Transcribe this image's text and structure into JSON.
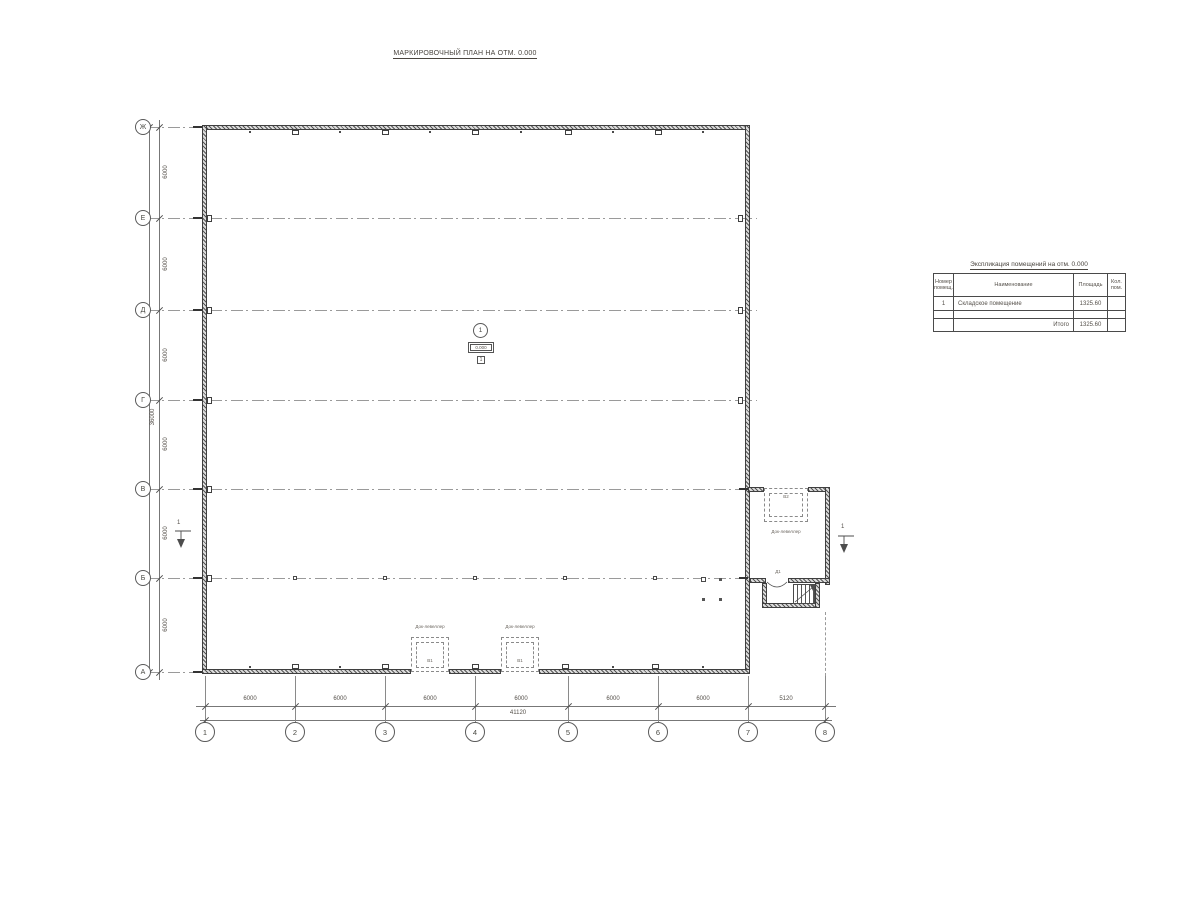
{
  "drawing_title": "МАРКИРОВОЧНЫЙ ПЛАН НА ОТМ. 0.000",
  "axis_rows": [
    "Ж",
    "Е",
    "Д",
    "Г",
    "В",
    "Б",
    "А"
  ],
  "axis_cols": [
    "1",
    "2",
    "3",
    "4",
    "5",
    "6",
    "7",
    "8"
  ],
  "dims": {
    "left_segments": [
      "6000",
      "6000",
      "6000",
      "6000",
      "6000",
      "6000"
    ],
    "left_total": "36000",
    "bottom_segments": [
      "6000",
      "6000",
      "6000",
      "6000",
      "6000",
      "6000",
      "5120"
    ],
    "bottom_total": "41120"
  },
  "room_tag": {
    "number": "1",
    "elevation": "0.000",
    "marker": "1"
  },
  "docks": {
    "label": "Док-левеллер",
    "tags": {
      "bottom_left": "В1",
      "bottom_right": "В1",
      "side": "В2"
    }
  },
  "door_tag": "Д1",
  "section_marks": {
    "left": "1",
    "right": "1"
  },
  "expl_table": {
    "title": "Экспликация помещений на отм. 0.000",
    "headers": {
      "num": "Номер помещ.",
      "name": "Наименование",
      "area": "Площадь",
      "count": "Кол. пом."
    },
    "rows": [
      {
        "num": "1",
        "name": "Складское помещение",
        "area": "1325.60",
        "count": ""
      },
      {
        "num": "",
        "name": "",
        "area": "",
        "count": ""
      },
      {
        "num": "",
        "name": "Итого",
        "area": "1325.60",
        "count": ""
      }
    ]
  }
}
